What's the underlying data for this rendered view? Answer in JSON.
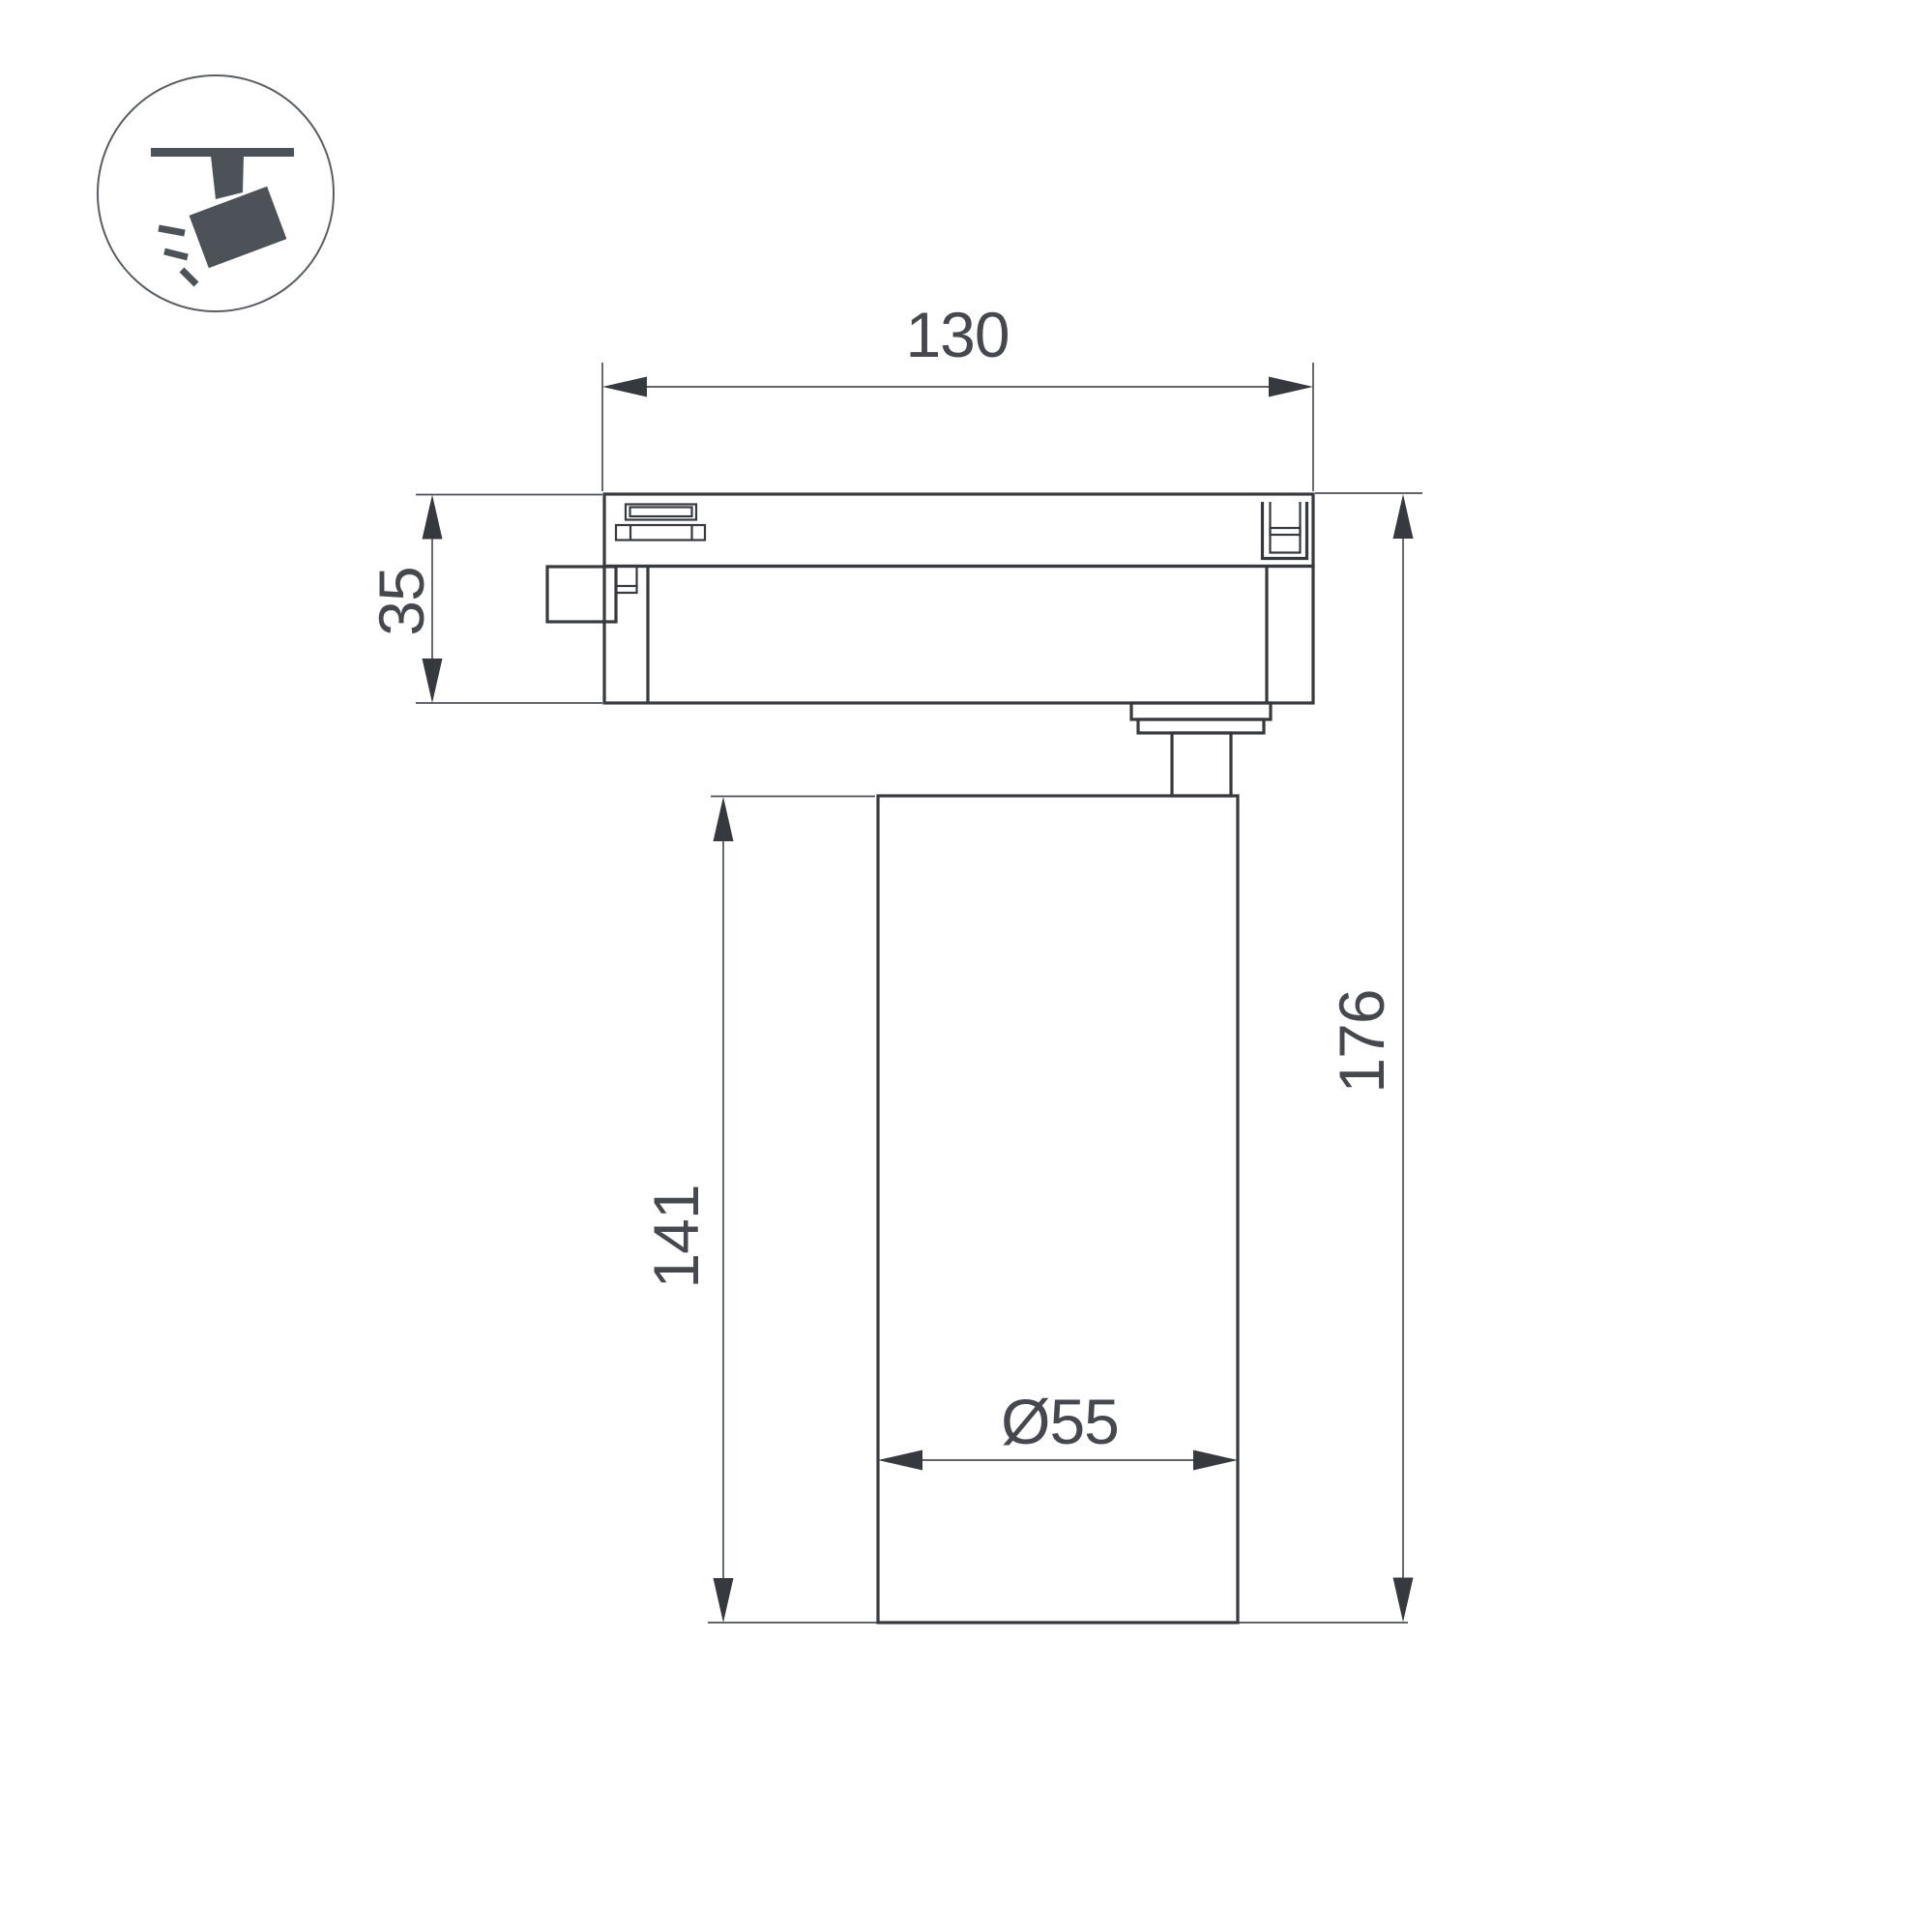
{
  "colors": {
    "background": "#ffffff",
    "line": "#36393d",
    "thin_line": "#4c5054",
    "text": "#45484c",
    "icon": "#4c5257",
    "icon_stroke": "#595e62"
  },
  "icon": {
    "name": "track-spotlight"
  },
  "dimensions": {
    "track_width": "130",
    "adapter_height": "35",
    "body_height": "141",
    "total_height": "176",
    "body_diameter": "Ø55"
  }
}
